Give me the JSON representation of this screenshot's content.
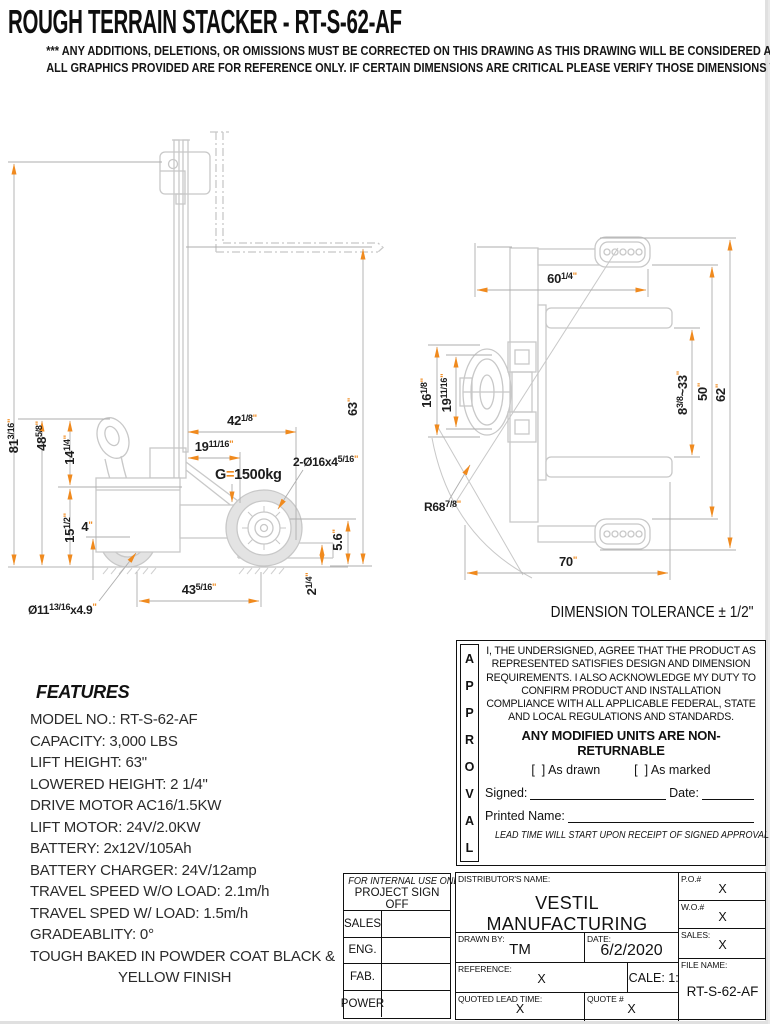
{
  "colors": {
    "accent_orange": "#f08a1e",
    "drawing_gray": "#c8c8c8"
  },
  "header": {
    "title": "ROUGH TERRAIN STACKER - RT-S-62-AF",
    "disclaimer_line1": "*** ANY ADDITIONS, DELETIONS, OR OMISSIONS MUST BE CORRECTED ON THIS DRAWING AS THIS DRAWING WILL BE CONSIDERED ALL INCLUSIVE ***",
    "disclaimer_line2": "ALL GRAPHICS PROVIDED ARE FOR REFERENCE ONLY. IF CERTAIN DIMENSIONS ARE CRITICAL PLEASE VERIFY THOSE DIMENSIONS WITH YOUR SALESPERSON"
  },
  "tolerance_note": "DIMENSION TOLERANCE ± 1/2\"",
  "side_view": {
    "dims": {
      "h81": {
        "m": "81",
        "s": "3/16",
        "u": "\""
      },
      "h48": {
        "m": "48",
        "s": "5/8",
        "u": "\""
      },
      "h14": {
        "m": "14",
        "s": "1/4",
        "u": "\""
      },
      "h15": {
        "m": "15",
        "s": "1/2",
        "u": "\""
      },
      "h4": {
        "m": "4",
        "u": "\""
      },
      "h63": {
        "m": "63",
        "u": "\""
      },
      "h56": {
        "m": "5.6",
        "u": "\""
      },
      "h214": {
        "m": "2",
        "s": "1/4",
        "u": "\""
      },
      "w42": {
        "m": "42",
        "s": "1/8",
        "u": "\""
      },
      "w19": {
        "m": "19",
        "s": "11/16",
        "u": "\""
      },
      "w43": {
        "m": "43",
        "s": "5/16",
        "u": "\""
      },
      "wheel": {
        "m": "Ø11",
        "s": "13/16",
        "x2": "x4.9",
        "u": "\""
      },
      "rollers": {
        "m": "2-Ø16x4",
        "s": "5/16",
        "u": "\""
      },
      "load": {
        "g": "G",
        "eq": "=",
        "v": "1500kg"
      }
    }
  },
  "top_view": {
    "dims": {
      "w60": {
        "m": "60",
        "s": "1/4",
        "u": "\""
      },
      "w70": {
        "m": "70",
        "u": "\""
      },
      "h16": {
        "m": "16",
        "s": "1/8",
        "u": "\""
      },
      "h19": {
        "m": "19",
        "s": "11/16",
        "u": "\""
      },
      "spread": {
        "m": "8",
        "s": "3/8",
        "x2": "~33",
        "u": "\""
      },
      "h50": {
        "m": "50",
        "u": "\""
      },
      "h62": {
        "m": "62",
        "u": "\""
      },
      "r68": {
        "m": "R68",
        "s": "7/8",
        "u": "\""
      }
    }
  },
  "features": {
    "heading": "FEATURES",
    "lines": [
      "MODEL NO.: RT-S-62-AF",
      "CAPACITY: 3,000 LBS",
      "LIFT HEIGHT: 63\"",
      "LOWERED HEIGHT: 2 1/4\"",
      "DRIVE MOTOR AC16/1.5KW",
      "LIFT MOTOR: 24V/2.0KW",
      "BATTERY: 2x12V/105Ah",
      "BATTERY CHARGER: 24V/12amp",
      "TRAVEL SPEED W/O LOAD: 2.1m/h",
      "TRAVEL SPED W/ LOAD: 1.5m/h",
      "GRADEABLITY: 0°",
      "TOUGH BAKED IN POWDER COAT BLACK &",
      "YELLOW FINISH"
    ]
  },
  "approval": {
    "vertical": [
      "A",
      "P",
      "P",
      "R",
      "O",
      "V",
      "A",
      "L"
    ],
    "text_lines": [
      "I, THE UNDERSIGNED, AGREE THAT THE PRODUCT AS",
      "REPRESENTED SATISFIES DESIGN AND DIMENSION",
      "REQUIREMENTS.  I ALSO ACKNOWLEDGE MY DUTY TO",
      "CONFIRM PRODUCT AND INSTALLATION",
      "COMPLIANCE WITH ALL APPLICABLE FEDERAL, STATE",
      "AND LOCAL REGULATIONS AND STANDARDS."
    ],
    "warning": "ANY MODIFIED UNITS ARE NON-RETURNABLE",
    "as_drawn": "[  ] As drawn",
    "as_marked": "[  ] As marked",
    "signed_label": "Signed:",
    "date_label": "Date:",
    "printed_label": "Printed Name:",
    "lead_note": "LEAD TIME WILL START UPON RECEIPT OF SIGNED APPROVAL DRAWING"
  },
  "sign_off": {
    "header_line1": "FOR INTERNAL USE ONLY",
    "header_line2": "PROJECT SIGN OFF",
    "rows": [
      "SALES",
      "ENG.",
      "FAB.",
      "POWER"
    ]
  },
  "title_block": {
    "distributor_label": "DISTRIBUTOR'S NAME:",
    "distributor": "VESTIL MANUFACTURING",
    "po_label": "P.O.#",
    "po": "X",
    "wo_label": "W.O.#",
    "wo": "X",
    "drawn_label": "DRAWN BY:",
    "drawn": "TM",
    "date_label": "DATE:",
    "date": "6/2/2020",
    "sales_label": "SALES:",
    "sales": "X",
    "ref_label": "REFERENCE:",
    "ref": "X",
    "scale": "SCALE: 1:2",
    "file_label": "FILE NAME:",
    "file": "RT-S-62-AF",
    "lead_label": "QUOTED LEAD TIME:",
    "lead": "X",
    "quote_label": "QUOTE #",
    "quote": "X"
  }
}
